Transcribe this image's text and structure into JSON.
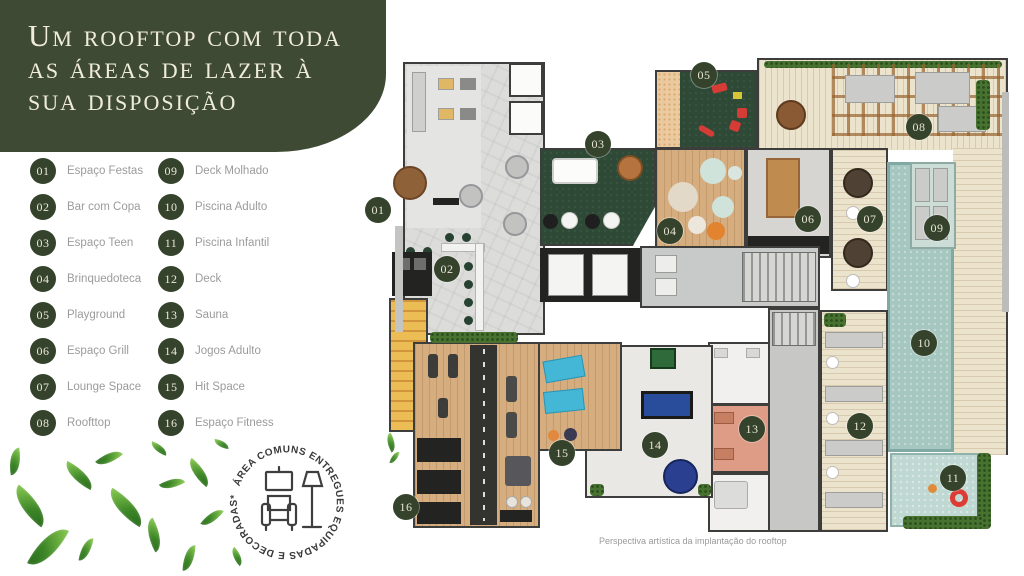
{
  "header": {
    "title_lines": [
      "Um rooftop com toda",
      "as áreas de lazer à",
      "sua disposição"
    ]
  },
  "legend": {
    "items": [
      {
        "num": "01",
        "label": "Espaço Festas"
      },
      {
        "num": "02",
        "label": "Bar com Copa"
      },
      {
        "num": "03",
        "label": "Espaço Teen"
      },
      {
        "num": "04",
        "label": "Brinquedoteca"
      },
      {
        "num": "05",
        "label": "Playground"
      },
      {
        "num": "06",
        "label": "Espaço Grill"
      },
      {
        "num": "07",
        "label": "Lounge Space"
      },
      {
        "num": "08",
        "label": "Roofttop"
      },
      {
        "num": "09",
        "label": "Deck Molhado"
      },
      {
        "num": "10",
        "label": "Piscina Adulto"
      },
      {
        "num": "11",
        "label": "Piscina Infantil"
      },
      {
        "num": "12",
        "label": "Deck"
      },
      {
        "num": "13",
        "label": "Sauna"
      },
      {
        "num": "14",
        "label": "Jogos Adulto"
      },
      {
        "num": "15",
        "label": "Hit Space"
      },
      {
        "num": "16",
        "label": "Espaço Fitness"
      }
    ]
  },
  "stamp": {
    "circular_text": "ÁREA COMUNS ENTREGUES  EQUIPADAS E DECORADAS*",
    "icon": "armchair-lamp-icon"
  },
  "floorplan": {
    "caption": "Perspectiva artística da implantação do rooftop",
    "markers": [
      {
        "num": "01",
        "x": 378,
        "y": 210
      },
      {
        "num": "02",
        "x": 447,
        "y": 269
      },
      {
        "num": "03",
        "x": 598,
        "y": 144
      },
      {
        "num": "04",
        "x": 670,
        "y": 231
      },
      {
        "num": "05",
        "x": 704,
        "y": 75
      },
      {
        "num": "06",
        "x": 808,
        "y": 219
      },
      {
        "num": "07",
        "x": 870,
        "y": 219
      },
      {
        "num": "08",
        "x": 919,
        "y": 127
      },
      {
        "num": "09",
        "x": 937,
        "y": 228
      },
      {
        "num": "10",
        "x": 924,
        "y": 343
      },
      {
        "num": "11",
        "x": 953,
        "y": 478
      },
      {
        "num": "12",
        "x": 860,
        "y": 426
      },
      {
        "num": "13",
        "x": 752,
        "y": 429
      },
      {
        "num": "14",
        "x": 655,
        "y": 445
      },
      {
        "num": "15",
        "x": 562,
        "y": 453
      },
      {
        "num": "16",
        "x": 406,
        "y": 507
      }
    ]
  },
  "colors": {
    "brand_green": "#3E4A34",
    "marker_green": "#35432C",
    "label_gray": "#9B9B9B",
    "pool_teal": "#A6C6C0"
  }
}
